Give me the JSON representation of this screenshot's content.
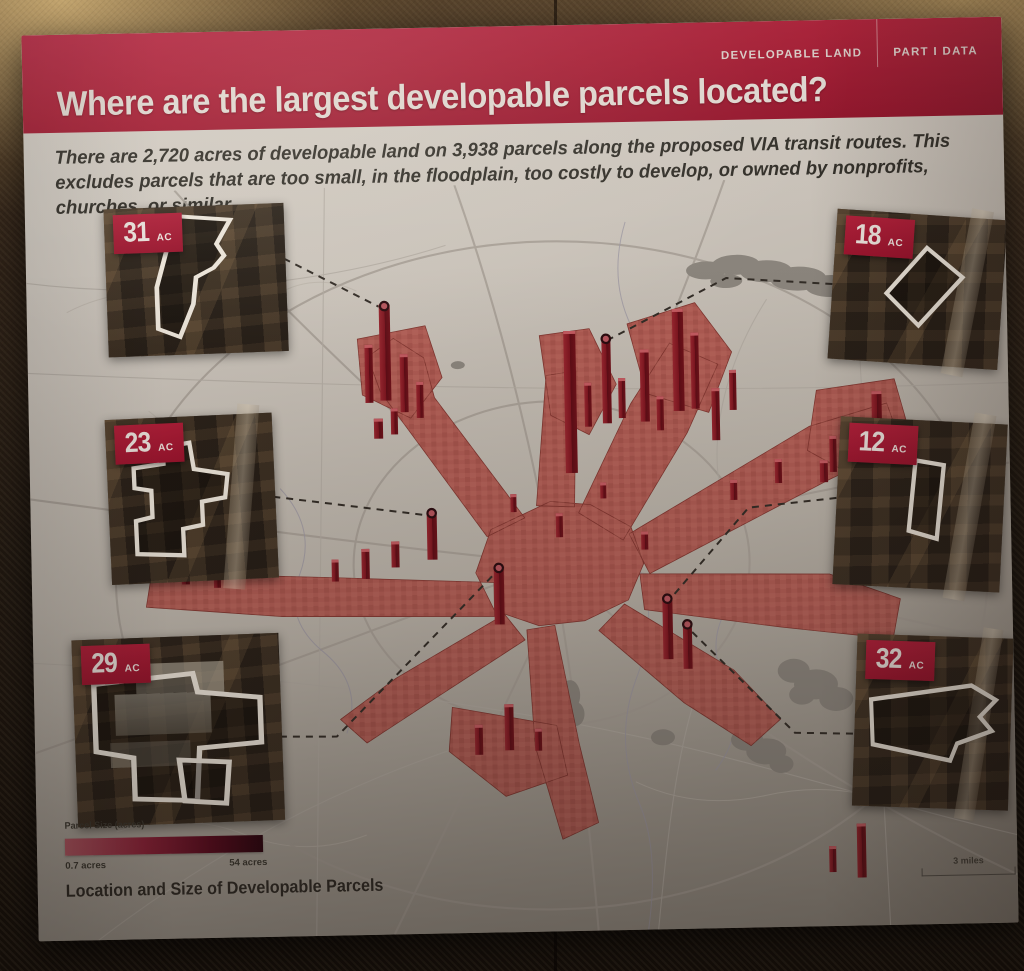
{
  "exhibit": {
    "category_label": "DEVELOPABLE LAND",
    "part_label": "PART I DATA",
    "title": "Where are the largest developable parcels located?",
    "intro": "There are 2,720 acres of developable land on 3,938 parcels along the proposed VIA transit routes. This excludes parcels that are too small, in the floodplain, too costly to develop, or owned by nonprofits, churches, or similar."
  },
  "insets": [
    {
      "value": "31",
      "unit": "AC",
      "position": "top-left"
    },
    {
      "value": "23",
      "unit": "AC",
      "position": "middle-left"
    },
    {
      "value": "29",
      "unit": "AC",
      "position": "bottom-left"
    },
    {
      "value": "18",
      "unit": "AC",
      "position": "top-right"
    },
    {
      "value": "12",
      "unit": "AC",
      "position": "middle-right"
    },
    {
      "value": "32",
      "unit": "AC",
      "position": "bottom-right"
    }
  ],
  "legend": {
    "title": "Parcel Size (acres)",
    "min_label": "0.7 acres",
    "max_label": "54 acres"
  },
  "caption": "Location and Size of Developable Parcels",
  "scale_label": "3 miles",
  "chart_data": {
    "type": "heatmap",
    "title": "Location and Size of Developable Parcels",
    "units": "acres",
    "value_range": [
      0.7,
      54
    ],
    "highlighted_parcels_acres": [
      31,
      23,
      29,
      18,
      12,
      32
    ],
    "totals": {
      "developable_acres": "2,720",
      "parcel_count": "3,938"
    },
    "legend_position": "bottom-left"
  },
  "colors": {
    "header_red": "#a3172f",
    "badge_red": "#a4182f",
    "parcel_flat": "#ad5a52",
    "parcel_tower": "#7c151f",
    "legend_gradient_start": "#b25662",
    "legend_gradient_end": "#2a040e",
    "map_ground": "#c9c2b9",
    "lake_gray": "#8a847c"
  }
}
